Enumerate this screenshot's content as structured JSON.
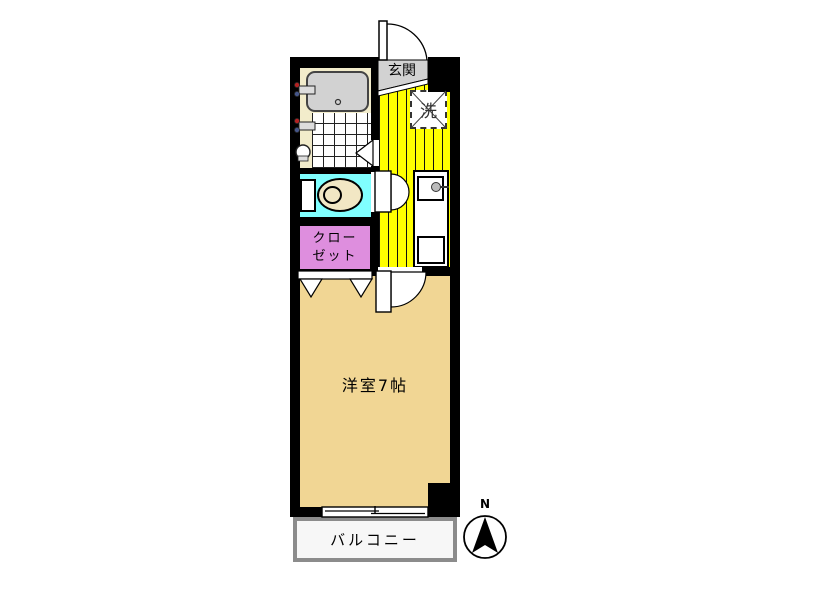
{
  "labels": {
    "entrance": "玄関",
    "laundry": "洗",
    "closet_line1": "クロー",
    "closet_line2": "ゼット",
    "main_room": "洋室7帖",
    "balcony": "バルコニー",
    "compass_north": "N"
  },
  "colors": {
    "wall": "#000000",
    "bath_floor": "#F2ECCB",
    "bathtub": "#D2D2D2",
    "entrance_floor": "#D2D2D2",
    "kitchen_floor": "#FFFF00",
    "toilet_room": "#80FFFF",
    "toilet_fixture": "#F2E7C4",
    "closet": "#DE8EDE",
    "main_room": "#F1D694",
    "balcony_fill": "#F7F7F7",
    "balcony_border": "#8C8C8C"
  }
}
